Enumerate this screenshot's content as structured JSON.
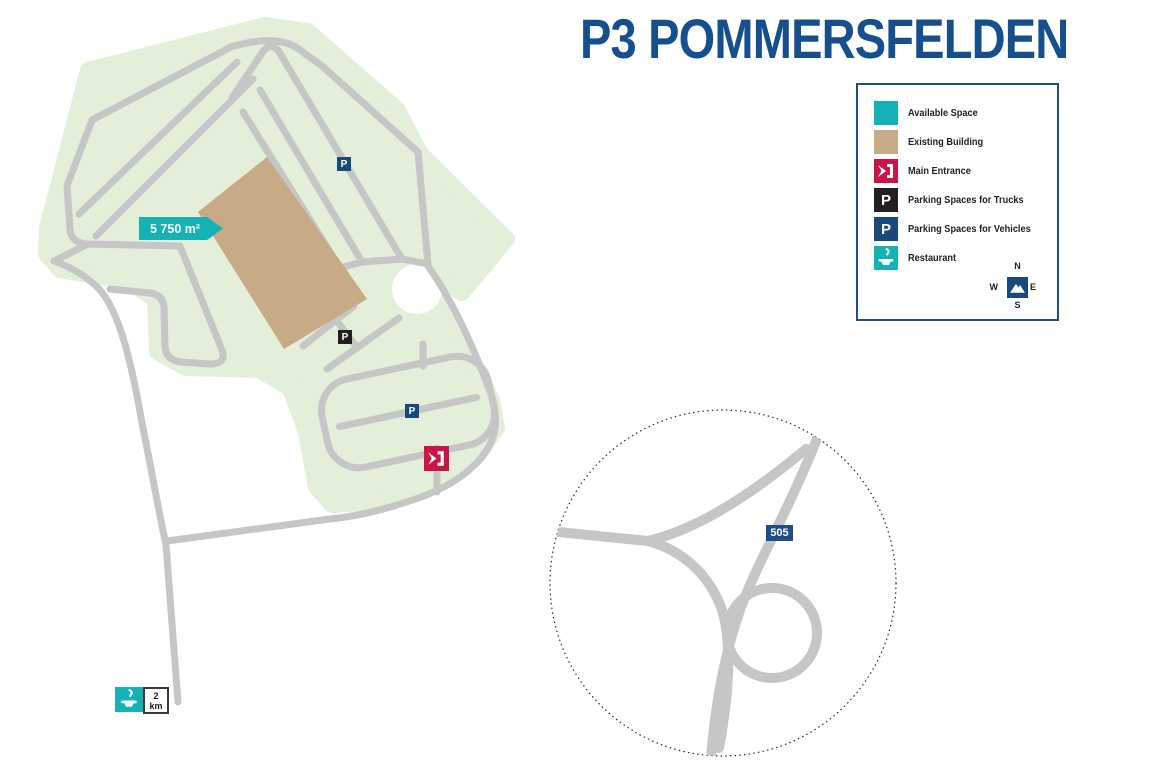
{
  "title": "P3 POMMERSFELDEN",
  "legend": {
    "items": [
      {
        "label": "Available Space"
      },
      {
        "label": "Existing Building"
      },
      {
        "label": "Main Entrance"
      },
      {
        "label": "Parking Spaces for Trucks"
      },
      {
        "label": "Parking Spaces for Vehicles"
      },
      {
        "label": "Restaurant"
      }
    ],
    "compass": {
      "n": "N",
      "e": "E",
      "s": "S",
      "w": "W"
    }
  },
  "map": {
    "area_label": "5 750 m²",
    "parking_letter": "P",
    "route_number": "505",
    "restaurant_distance": {
      "value": "2",
      "unit": "km"
    }
  },
  "colors": {
    "accent_teal": "#14b1b5",
    "building_tan": "#c9aa87",
    "entrance_red": "#ca1544",
    "brand_blue": "#1d4e89",
    "road_gray": "#c5c6c6",
    "area_green": "#e3efd8"
  }
}
